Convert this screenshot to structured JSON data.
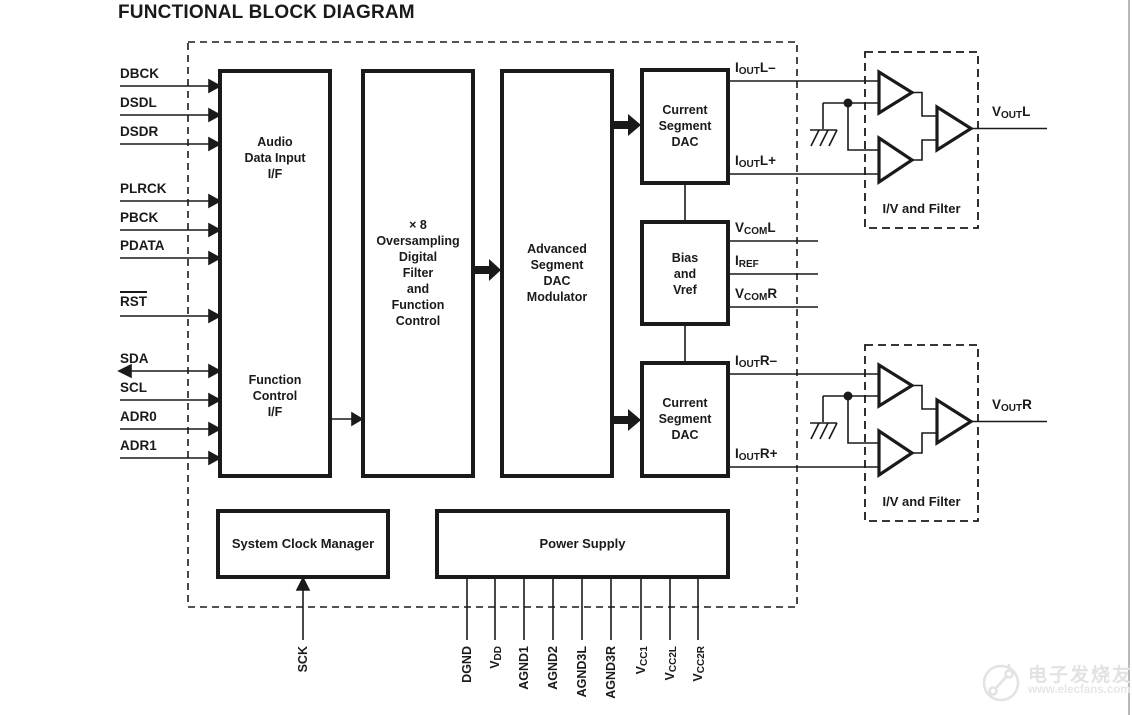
{
  "title": "FUNCTIONAL BLOCK DIAGRAM",
  "left_pins": [
    "DBCK",
    "DSDL",
    "DSDR",
    "PLRCK",
    "PBCK",
    "PDATA",
    "RST",
    "SDA",
    "SCL",
    "ADR0",
    "ADR1"
  ],
  "blocks": {
    "audio_if": "Audio\nData Input\nI/F",
    "function_if": "Function\nControl\nI/F",
    "oversampling": "× 8\nOversampling\nDigital\nFilter\nand\nFunction\nControl",
    "modulator": "Advanced\nSegment\nDAC\nModulator",
    "current_dac_l": "Current\nSegment\nDAC",
    "bias": "Bias\nand\nVref",
    "current_dac_r": "Current\nSegment\nDAC",
    "clock_manager": "System Clock Manager",
    "power_supply": "Power Supply",
    "iv_filter_l": "I/V and Filter",
    "iv_filter_r": "I/V and Filter"
  },
  "right_pins": [
    {
      "base": "I",
      "sub": "OUT",
      "post": "L–"
    },
    {
      "base": "I",
      "sub": "OUT",
      "post": "L+"
    },
    {
      "base": "V",
      "sub": "COM",
      "post": "L"
    },
    {
      "base": "I",
      "sub": "REF",
      "post": ""
    },
    {
      "base": "V",
      "sub": "COM",
      "post": "R"
    },
    {
      "base": "I",
      "sub": "OUT",
      "post": "R–"
    },
    {
      "base": "I",
      "sub": "OUT",
      "post": "R+"
    }
  ],
  "outputs": [
    {
      "base": "V",
      "sub": "OUT",
      "post": "L"
    },
    {
      "base": "V",
      "sub": "OUT",
      "post": "R"
    }
  ],
  "bottom_pins": [
    {
      "base": "SCK",
      "sub": ""
    },
    {
      "base": "DGND",
      "sub": ""
    },
    {
      "base": "V",
      "sub": "DD"
    },
    {
      "base": "AGND1",
      "sub": ""
    },
    {
      "base": "AGND2",
      "sub": ""
    },
    {
      "base": "AGND3L",
      "sub": ""
    },
    {
      "base": "AGND3R",
      "sub": ""
    },
    {
      "base": "V",
      "sub": "CC1"
    },
    {
      "base": "V",
      "sub": "CC2L"
    },
    {
      "base": "V",
      "sub": "CC2R"
    }
  ],
  "watermark": {
    "name": "电子发烧友",
    "url": "www.elecfans.com"
  },
  "colors": {
    "line": "#1a1a1a",
    "watermark": "#e2e2e2"
  }
}
